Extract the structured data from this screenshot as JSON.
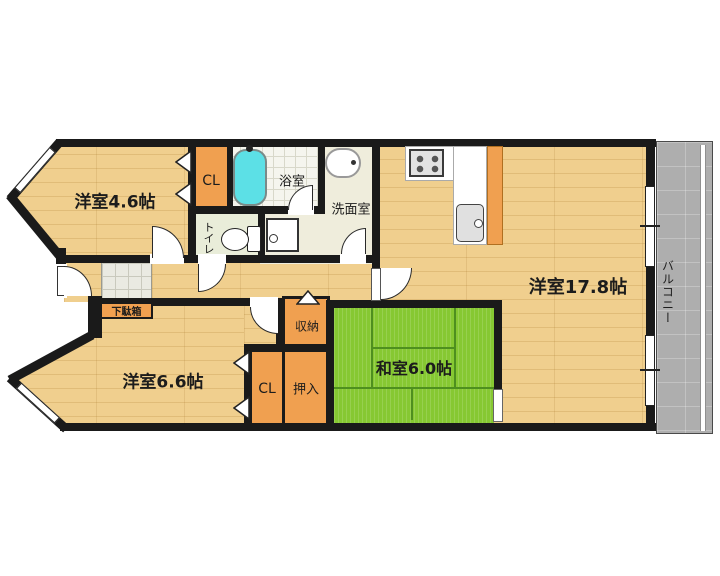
{
  "rooms": {
    "western_4_6": {
      "label": "洋室4.6帖"
    },
    "closet_upper": {
      "label": "CL"
    },
    "bathroom": {
      "label": "浴室"
    },
    "washroom": {
      "label": "洗面室"
    },
    "toilet": {
      "label": "トイレ"
    },
    "western_17_8": {
      "label": "洋室17.8帖"
    },
    "balcony": {
      "label": "バルコニー"
    },
    "shoe_cabinet": {
      "label": "下駄箱"
    },
    "western_6_6": {
      "label": "洋室6.6帖"
    },
    "closet_lower": {
      "label": "CL"
    },
    "oshiire": {
      "label": "押入"
    },
    "storage": {
      "label": "収納"
    },
    "japanese_6_0": {
      "label": "和室6.0帖"
    }
  },
  "colors": {
    "wall": "#1a1a1a",
    "wood": "#f0cf8e",
    "tatami": "#86c832",
    "tatamiline": "#4e8f1f",
    "closet": "#f0a050",
    "balcony": "#aeaeae",
    "bathtub": "#5ce0e6",
    "cream": "#efeddc",
    "toiletf": "#e9edd9"
  }
}
